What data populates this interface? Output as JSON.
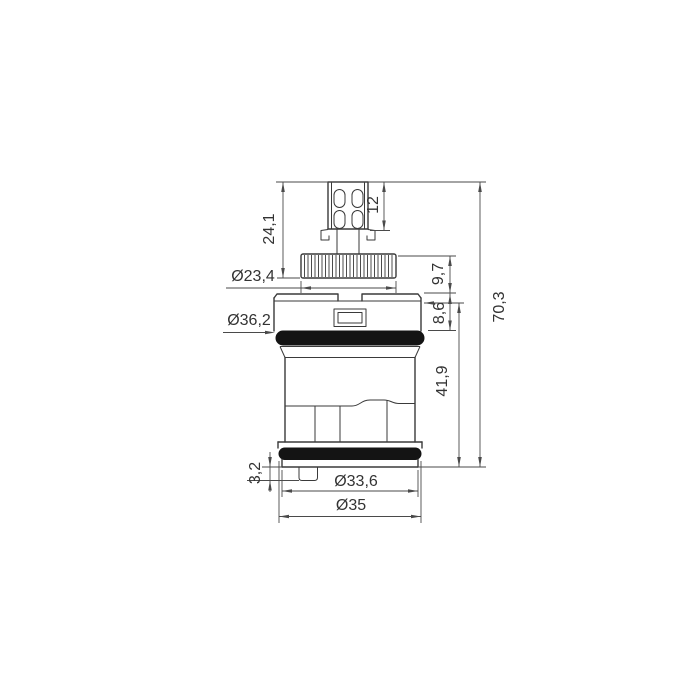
{
  "drawing": {
    "type": "technical-drawing",
    "subject": "single-lever mixer cartridge, side elevation with dimensions",
    "units_style": "millimetres, decimal comma",
    "background": "#ffffff",
    "line_color": "#3a3a3a",
    "oring_color": "#141414",
    "labels": {
      "stem_height": "24,1",
      "stem_slot_height": "12",
      "spline_diameter": "Ø23,4",
      "spline_height": "9,7",
      "head_oring_diameter": "Ø36,2",
      "cap_height": "8,6",
      "total_height": "70,3",
      "body_height": "41,9",
      "foot_tab_height": "3,2",
      "base_inner_diameter": "Ø33,6",
      "base_outer_diameter": "Ø35"
    }
  }
}
